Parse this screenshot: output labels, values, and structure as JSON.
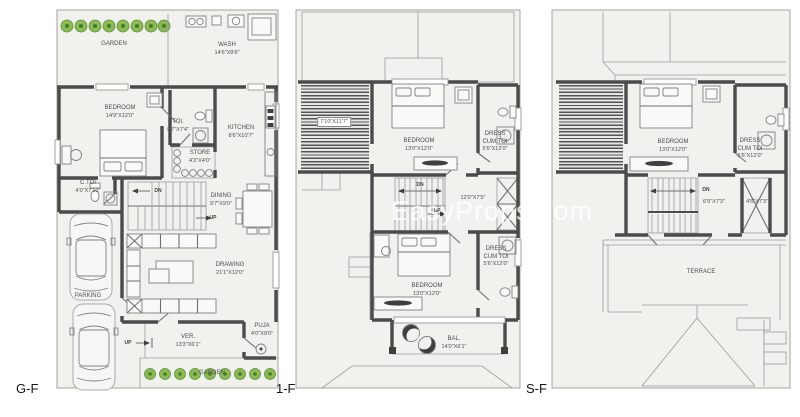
{
  "watermark": "EasyProps.com",
  "colors": {
    "wall": "#4b4b4b",
    "plan_fill": "#f1f1ee",
    "line": "#9c9c9c",
    "garden_green": "#8abb56",
    "watermark_white": "#ffffff"
  },
  "floors": {
    "gf": {
      "tag": "G-F",
      "garden_top": "GARDEN",
      "garden_bottom": "GARDEN",
      "wash": {
        "name": "WASH",
        "dim": "14'6\"X9'6\""
      },
      "bedroom": {
        "name": "BEDROOM",
        "dim": "14'9\"X12'0\""
      },
      "toi": {
        "name": "TOI.",
        "dim": "9'7\"X7'4\""
      },
      "kitchen": {
        "name": "KITCHEN",
        "dim": "8'6\"X10'7\""
      },
      "store": {
        "name": "STORE",
        "dim": "4'3\"X4'0\""
      },
      "ctoi": {
        "name": "C.TOI",
        "dim": "4'0\"X7'10\""
      },
      "dining": {
        "name": "DINING",
        "dim": "9'7\"X9'0\""
      },
      "drawing": {
        "name": "DRAWING",
        "dim": "21'1\"X12'0\""
      },
      "parking": "PARKING",
      "ver": {
        "name": "VER.",
        "dim": "13'3\"X6'1\""
      },
      "puja": {
        "name": "PUJA",
        "dim": "4'0\"X9'0\""
      },
      "dn": "DN",
      "up_stairs": "UP",
      "up_ver": "UP"
    },
    "ff": {
      "tag": "1-F",
      "deck_dim": "7'10\"X11'7\"",
      "bedroom1": {
        "name": "BEDROOM",
        "dim": "13'0\"X12'0\""
      },
      "dress1": {
        "l1": "DRESS",
        "l2": "CUM TOI",
        "dim": "5'6\"X12'0\""
      },
      "hall_dim": "12'0\"X7'5\"",
      "dn": "DN",
      "up": "UP",
      "bedroom2": {
        "name": "BEDROOM",
        "dim": "13'0\"X12'0\""
      },
      "dress2": {
        "l1": "DRESS",
        "l2": "CUM TOI",
        "dim": "5'6\"X12'0\""
      },
      "bal": {
        "name": "BAL.",
        "dim": "14'0\"X6'1\""
      }
    },
    "sf": {
      "tag": "S-F",
      "bedroom": {
        "name": "BEDROOM",
        "dim": "13'0\"X12'0\""
      },
      "dress": {
        "l1": "DRESS",
        "l2": "CUM TOI",
        "dim": "5'6\"X12'0\""
      },
      "dn": "DN",
      "hall_dim": "6'9\"X7'3\"",
      "shaft_dim": "4'6\"X7'3\"",
      "terrace": "TERRACE"
    }
  }
}
